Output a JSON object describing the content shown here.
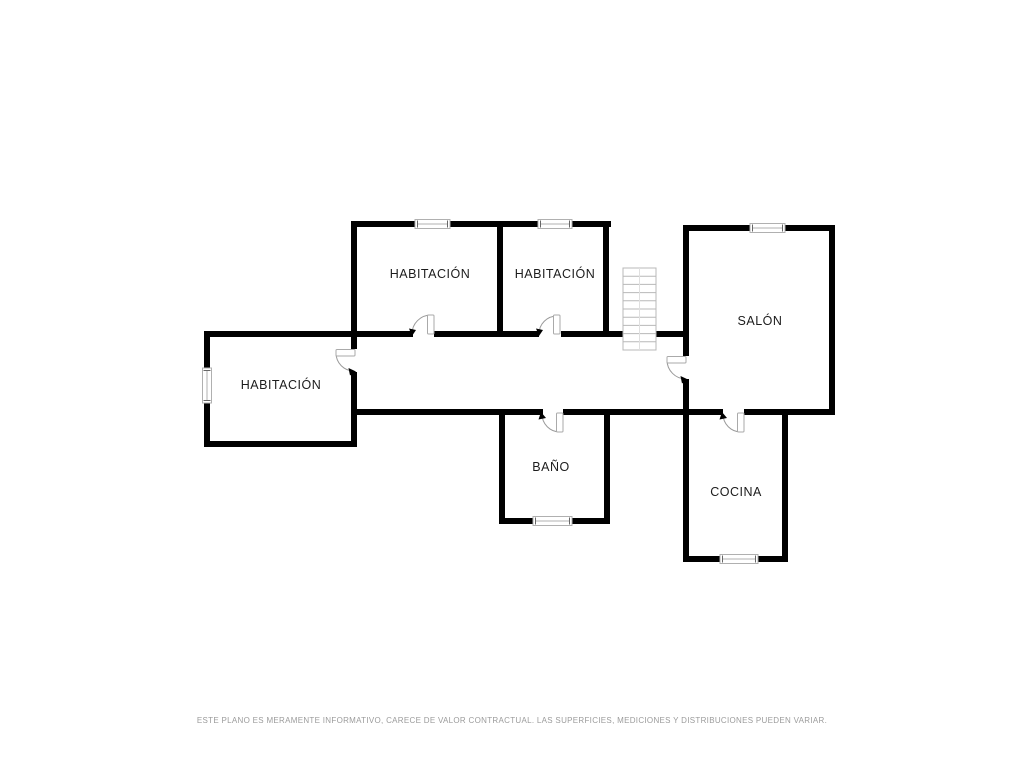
{
  "plan": {
    "rooms": [
      {
        "id": "habitacion-oeste",
        "label": "HABITACIÓN"
      },
      {
        "id": "habitacion-centro",
        "label": "HABITACIÓN"
      },
      {
        "id": "habitacion-este",
        "label": "HABITACIÓN"
      },
      {
        "id": "salon",
        "label": "SALÓN"
      },
      {
        "id": "bano",
        "label": "BAÑO"
      },
      {
        "id": "cocina",
        "label": "COCINA"
      }
    ],
    "disclaimer": "ESTE PLANO ES MERAMENTE INFORMATIVO, CARECE DE VALOR CONTRACTUAL. LAS SUPERFICIES, MEDICIONES Y DISTRIBUCIONES PUEDEN VARIAR.",
    "colors": {
      "wall": "#000000",
      "fixture_outline": "#b0b0b0",
      "door_arc": "#9a9a9a",
      "arrow": "#000000",
      "label_text": "#1c1c1c",
      "disclaimer_text": "#9b9b9b",
      "background": "#ffffff"
    },
    "features": {
      "windows": 6,
      "doors": 6,
      "staircase_treads": 10
    }
  }
}
